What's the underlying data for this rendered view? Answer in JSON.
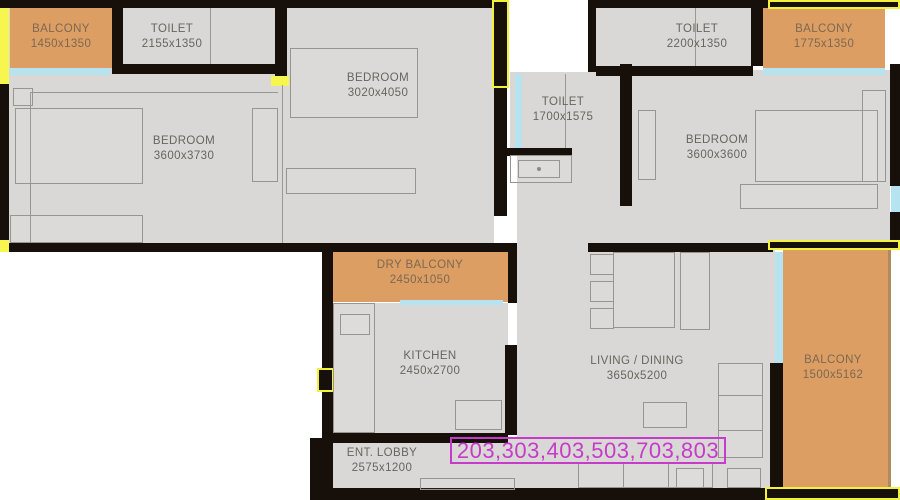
{
  "annotation": {
    "text": "203,303,403,503,703,803"
  },
  "rooms": {
    "balcony_top_left": {
      "name": "BALCONY",
      "dims": "1450x1350"
    },
    "toilet_top_left": {
      "name": "TOILET",
      "dims": "2155x1350"
    },
    "bedroom_top_center": {
      "name": "BEDROOM",
      "dims": "3020x4050"
    },
    "toilet_top_right": {
      "name": "TOILET",
      "dims": "2200x1350"
    },
    "balcony_top_right": {
      "name": "BALCONY",
      "dims": "1775x1350"
    },
    "bedroom_left": {
      "name": "BEDROOM",
      "dims": "3600x3730"
    },
    "toilet_middle": {
      "name": "TOILET",
      "dims": "1700x1575"
    },
    "bedroom_right": {
      "name": "BEDROOM",
      "dims": "3600x3600"
    },
    "dry_balcony": {
      "name": "DRY BALCONY",
      "dims": "2450x1050"
    },
    "kitchen": {
      "name": "KITCHEN",
      "dims": "2450x2700"
    },
    "living_dining": {
      "name": "LIVING / DINING",
      "dims": "3650x5200"
    },
    "balcony_right": {
      "name": "BALCONY",
      "dims": "1500x5162"
    },
    "entrance_lobby": {
      "name": "ENT. LOBBY",
      "dims": "2575x1200"
    }
  },
  "colors": {
    "floor": "#d9d8d6",
    "wall": "#17100a",
    "balcony": "#dd9e63",
    "window_glass": "#b5e3ef",
    "window_marker": "#f7f64e",
    "annotation_accent": "#c63bc9",
    "label_text": "#66655f"
  }
}
